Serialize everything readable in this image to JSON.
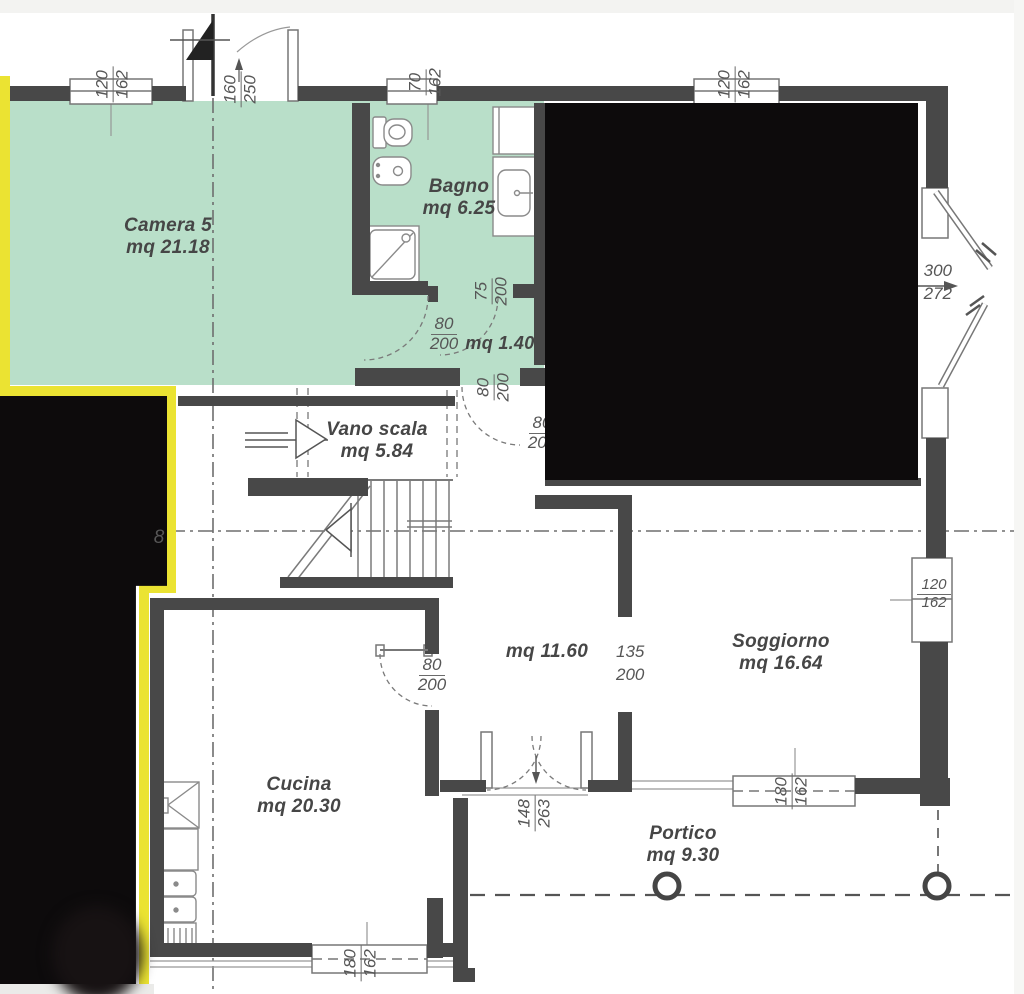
{
  "rooms": {
    "camera5": {
      "name": "Camera 5",
      "area": "mq 21.18"
    },
    "bagno": {
      "name": "Bagno",
      "area": "mq 6.25"
    },
    "disimpegno": {
      "area": "mq 1.40"
    },
    "vano_scala": {
      "name": "Vano scala",
      "area": "mq 5.84"
    },
    "hall": {
      "area": "mq 11.60"
    },
    "cucina": {
      "name": "Cucina",
      "area": "mq 20.30"
    },
    "soggiorno": {
      "name": "Soggiorno",
      "area": "mq 16.64"
    },
    "portico": {
      "name": "Portico",
      "area": "mq 9.30"
    }
  },
  "dims": {
    "win_top_left": {
      "w": "120",
      "h": "162"
    },
    "door_camera_top": {
      "w": "160",
      "h": "250"
    },
    "win_bagno": {
      "w": "70",
      "h": "162"
    },
    "win_top_right": {
      "w": "120",
      "h": "162"
    },
    "bay_window": {
      "w": "300",
      "h": "272"
    },
    "door_bagno": {
      "w": "75",
      "h": "200"
    },
    "door_camera": {
      "w": "80",
      "h": "200"
    },
    "door_hall": {
      "w": "80",
      "h": "200"
    },
    "door_right_room": {
      "w": "80",
      "h": "200"
    },
    "door_cucina": {
      "w": "80",
      "h": "200"
    },
    "opening_soggiorno": {
      "w": "135",
      "h": "200"
    },
    "french_door": {
      "w": "148",
      "h": "263"
    },
    "win_soggiorno_right": {
      "w": "120",
      "h": "162"
    },
    "win_soggiorno_bottom": {
      "w": "180",
      "h": "162"
    },
    "win_cucina_bottom": {
      "w": "180",
      "h": "162"
    },
    "partial": "8"
  },
  "colors": {
    "highlight_green": "#b9dfc9",
    "highlight_yellow": "#ebe332",
    "redaction": "#0d0b0c",
    "wall": "#484848",
    "thin_line": "#8a8a8a",
    "text": "#464646"
  }
}
